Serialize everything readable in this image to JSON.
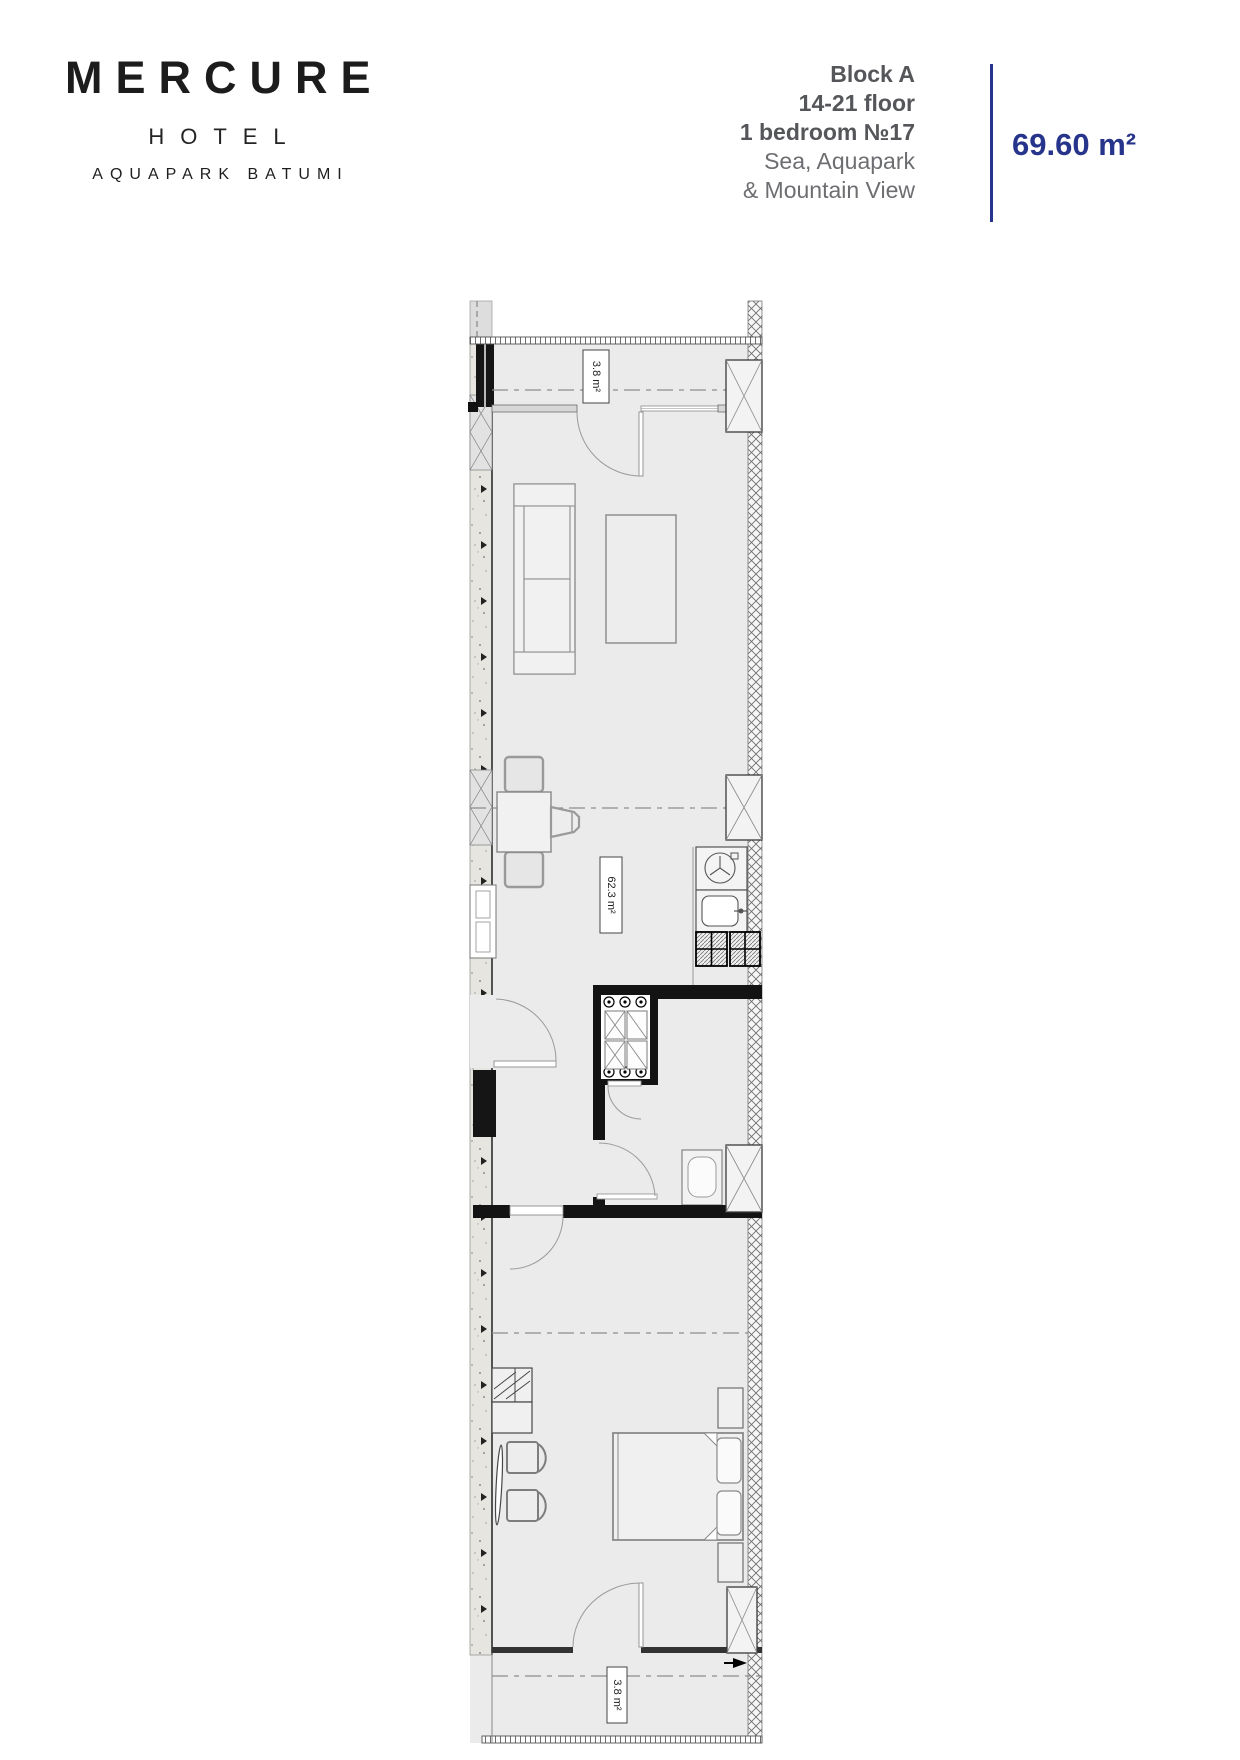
{
  "header": {
    "brand": {
      "name": "MERCURE",
      "type": "HOTEL",
      "location": "AQUAPARK BATUMI"
    },
    "unit": {
      "block": "Block A",
      "floor_range": "14-21 floor",
      "bedroom": "1 bedroom №17",
      "view1": "Sea, Aquapark",
      "view2": "& Mountain View"
    },
    "area": {
      "value": "69.60 m²"
    },
    "colors": {
      "accent": "#27348b",
      "muted_text": "#58595b",
      "logo_text": "#1c1c1c"
    }
  },
  "floor_plan": {
    "labels": {
      "balcony_top": "3.8 m²",
      "living_total": "62.3 m²",
      "balcony_bottom": "3.8 m²"
    }
  }
}
